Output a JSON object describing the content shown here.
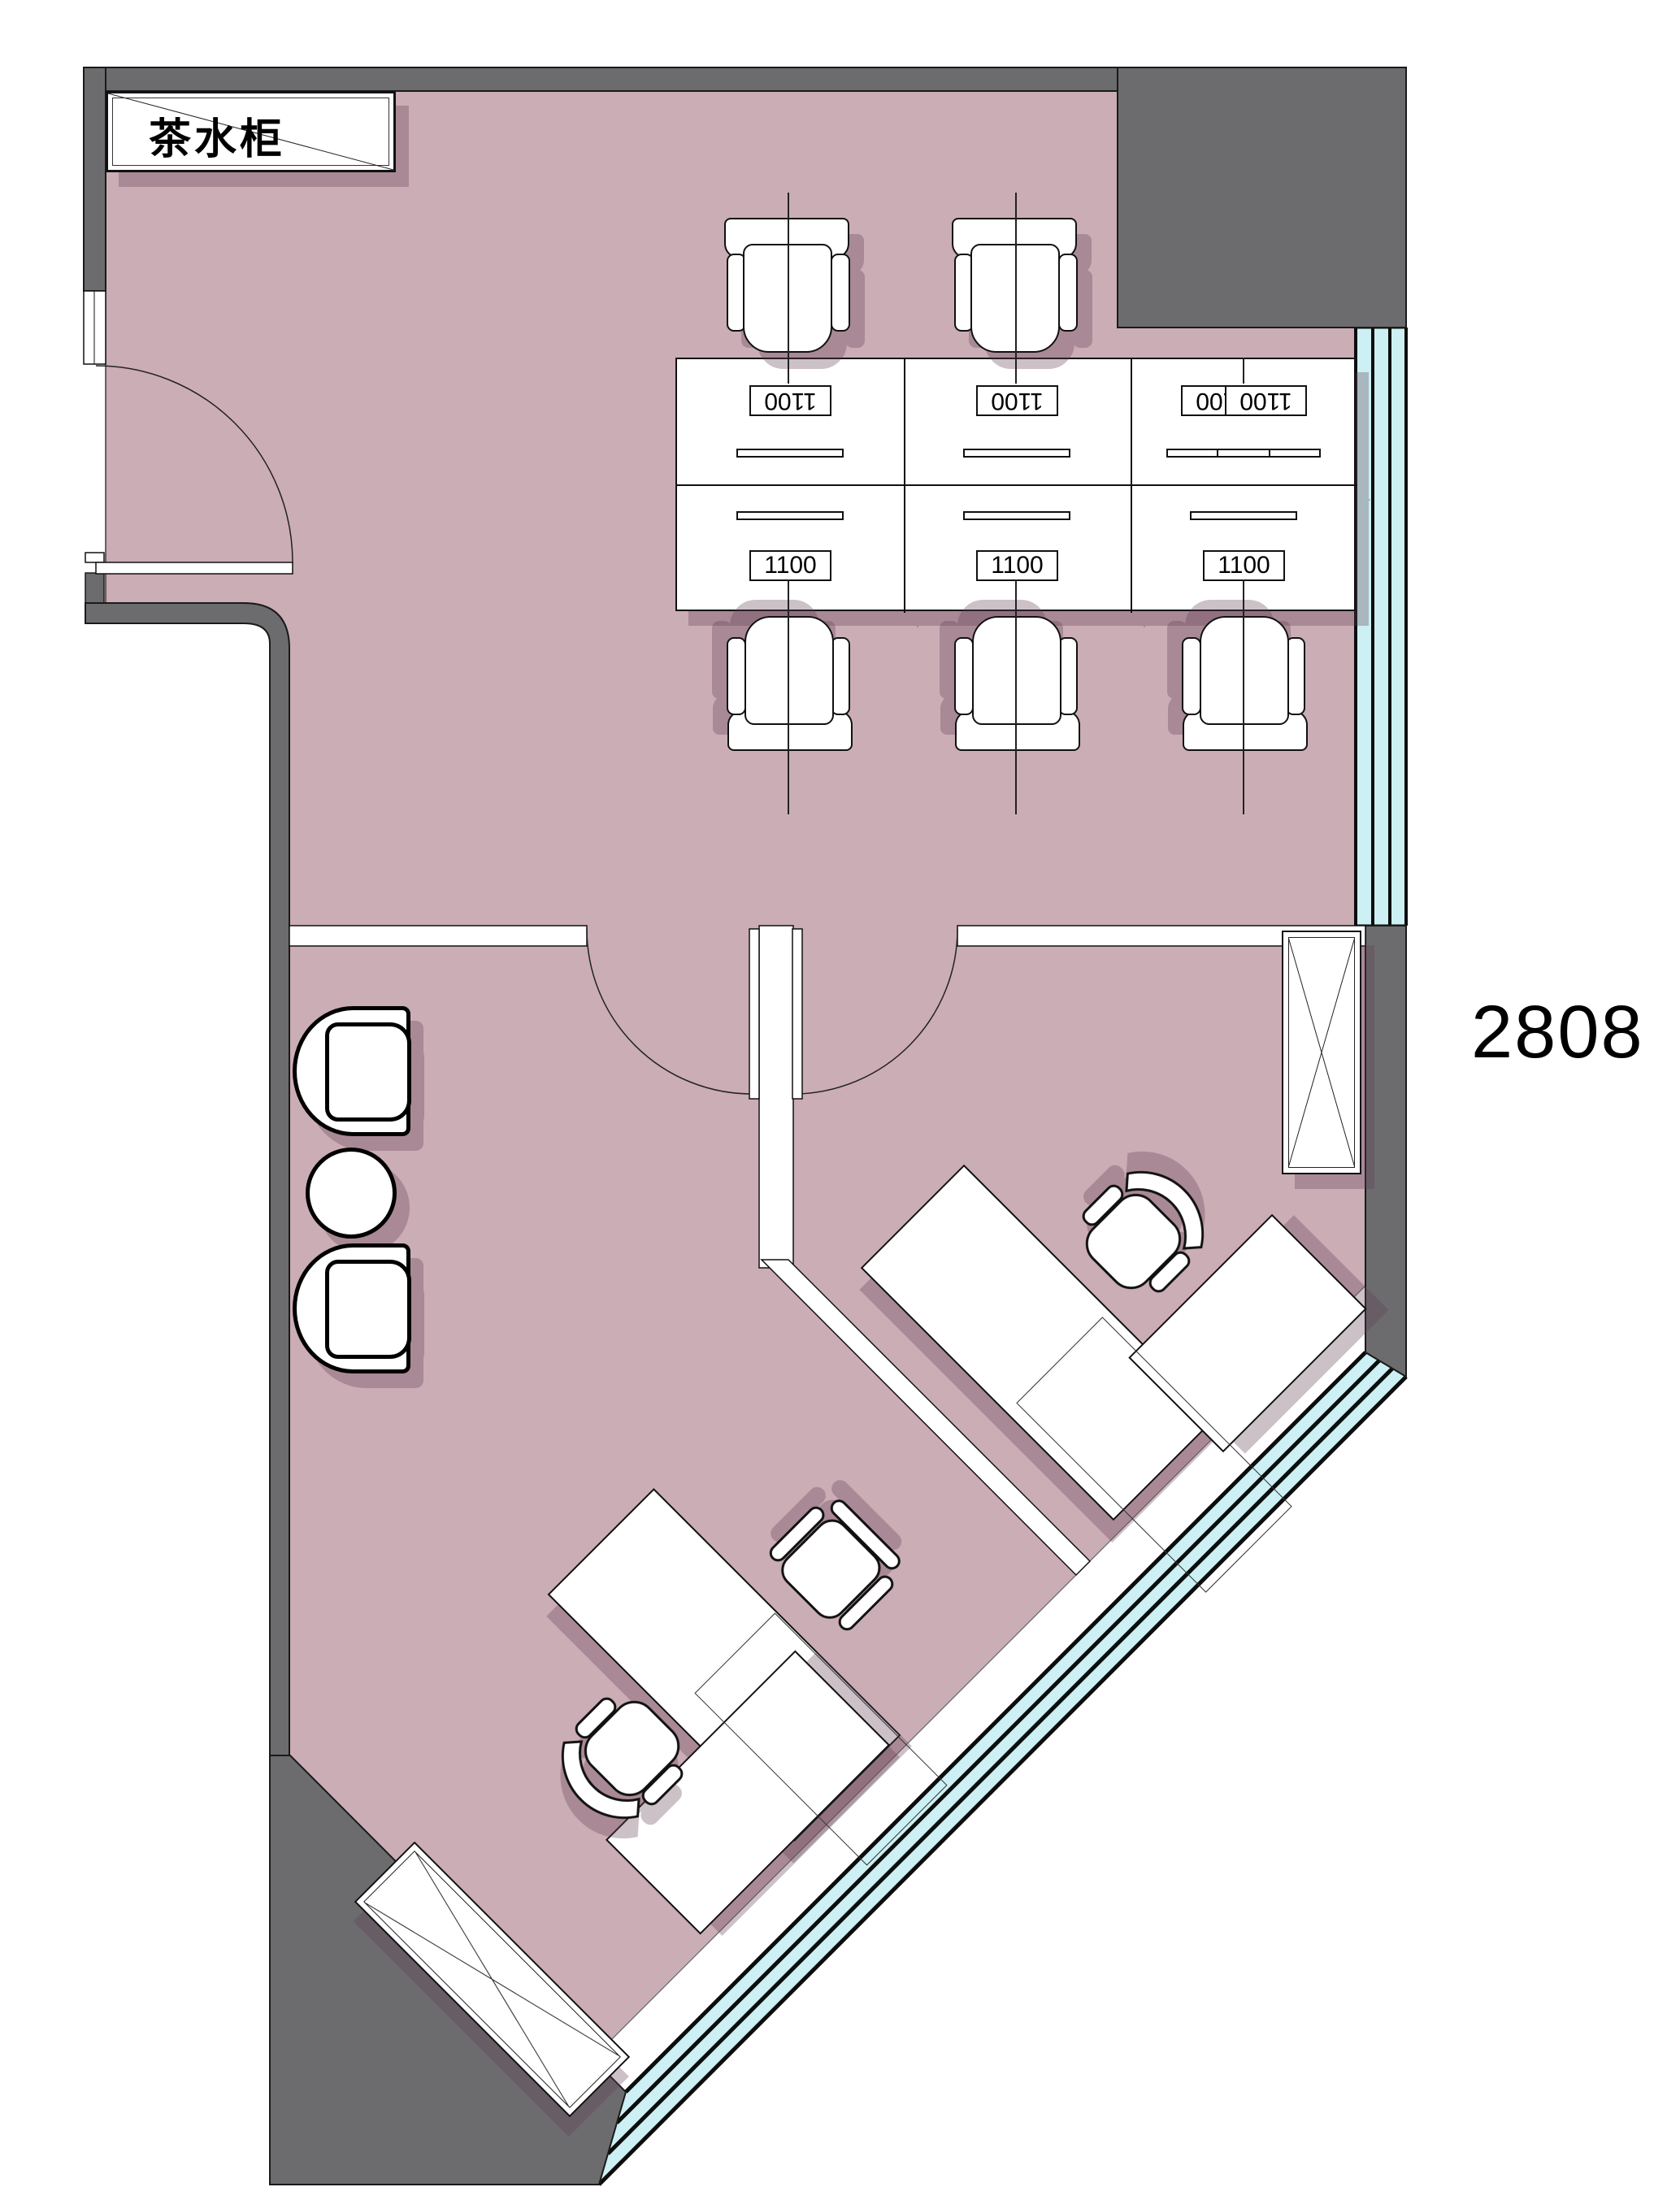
{
  "title": {
    "room_number": "2808"
  },
  "tea_cabinet": {
    "label": "茶水柜"
  },
  "desk_block": {
    "rows": 2,
    "cols": 3,
    "cells": [
      {
        "id": "r1c1",
        "label": "1100"
      },
      {
        "id": "r1c2",
        "label": "1100"
      },
      {
        "id": "r1c3",
        "label": "1100",
        "label2": "1100"
      },
      {
        "id": "r2c1",
        "label": "1100"
      },
      {
        "id": "r2c2",
        "label": "1100"
      },
      {
        "id": "r2c3",
        "label": "1100"
      }
    ]
  },
  "colors": {
    "floor": "#cbadb5",
    "wall": "#6c6c6e",
    "window_glass": "#ccf0f4",
    "outline": "#1a1a1a",
    "furniture_fill": "#ffffff",
    "shadow": "rgba(96,62,80,0.32)"
  },
  "symbols": {
    "tea_cabinet": "rectangle-with-diagonal",
    "storage_cabinet": "rectangle-with-x-cross",
    "window": "triple-line-glazing-band",
    "door": "quarter-circle-swing"
  }
}
